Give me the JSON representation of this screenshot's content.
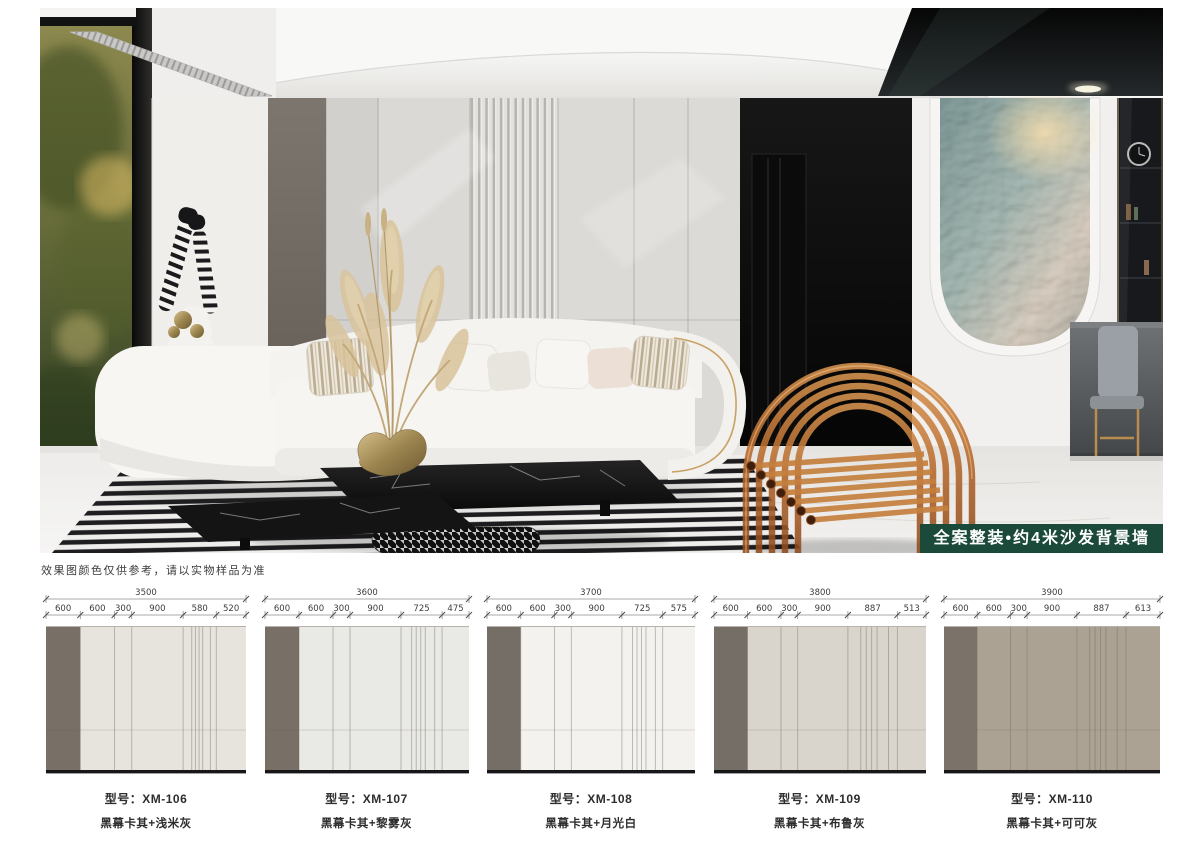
{
  "hero": {
    "badge": {
      "label": "全案整装•约4米沙发背景墙",
      "bg_color": "#1b4a3b",
      "text_color": "#ffffff"
    }
  },
  "disclaimer": "效果图颜色仅供参考，请以实物样品为准",
  "spec_panels": [
    {
      "model_label": "型号：XM-106",
      "finish_label": "黑幕卡其+浅米灰",
      "total_mm": 3500,
      "segments_mm": [
        600,
        600,
        300,
        900,
        580,
        520
      ],
      "accent_segment_color": "#786f66",
      "panel_color": "#e7e4dd"
    },
    {
      "model_label": "型号：XM-107",
      "finish_label": "黑幕卡其+黎雾灰",
      "total_mm": 3600,
      "segments_mm": [
        600,
        600,
        300,
        900,
        725,
        475
      ],
      "accent_segment_color": "#786f66",
      "panel_color": "#e9e9e5"
    },
    {
      "model_label": "型号：XM-108",
      "finish_label": "黑幕卡其+月光白",
      "total_mm": 3700,
      "segments_mm": [
        600,
        600,
        300,
        900,
        725,
        575
      ],
      "accent_segment_color": "#756e66",
      "panel_color": "#f4f2ef"
    },
    {
      "model_label": "型号：XM-109",
      "finish_label": "黑幕卡其+布鲁灰",
      "total_mm": 3800,
      "segments_mm": [
        600,
        600,
        300,
        900,
        887,
        513
      ],
      "accent_segment_color": "#756e66",
      "panel_color": "#d9d5cd"
    },
    {
      "model_label": "型号：XM-110",
      "finish_label": "黑幕卡其+可可灰",
      "total_mm": 3900,
      "segments_mm": [
        600,
        600,
        300,
        900,
        887,
        613
      ],
      "accent_segment_color": "#7b7369",
      "panel_color": "#aca293"
    }
  ]
}
